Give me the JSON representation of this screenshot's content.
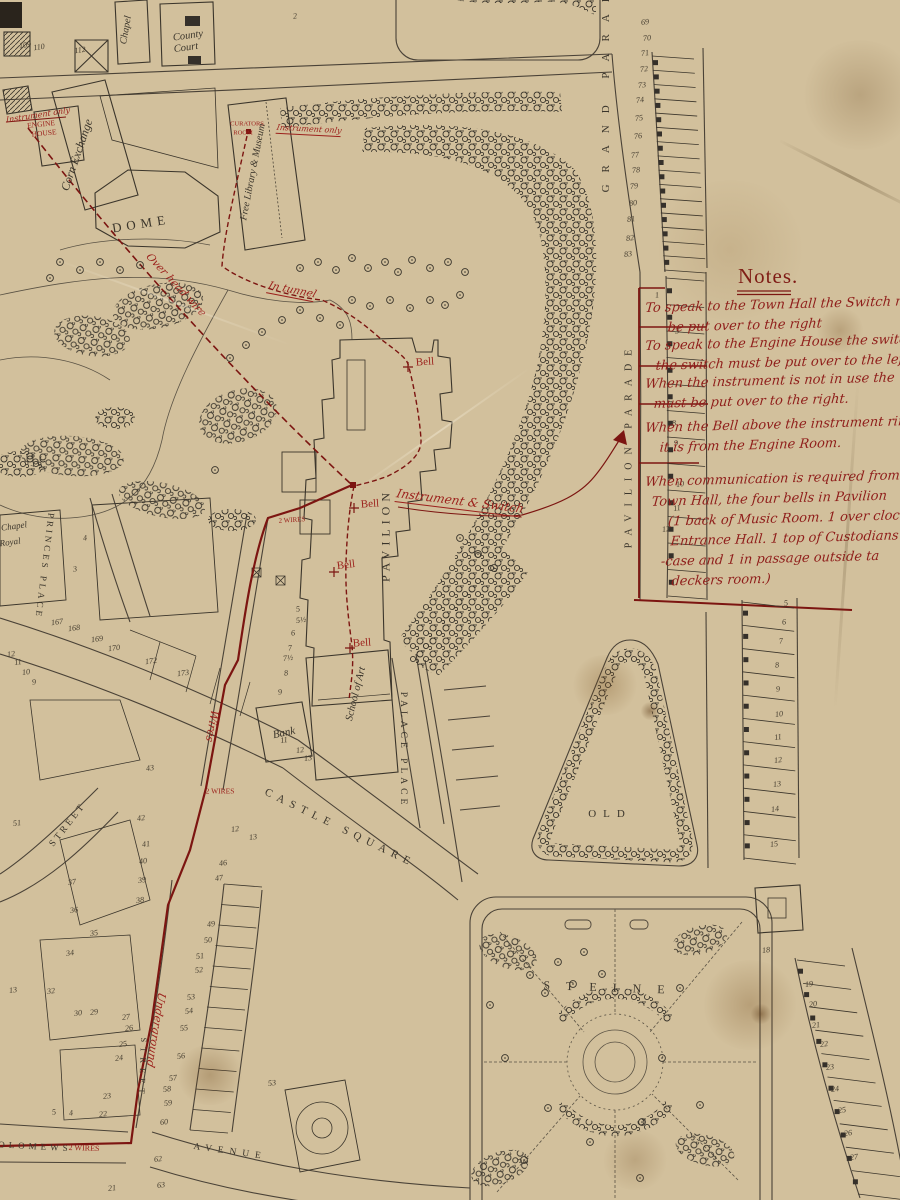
{
  "map_title_area": {
    "notes_title": "Notes."
  },
  "notes": {
    "title": "Notes.",
    "items": [
      {
        "lines": [
          {
            "t": "To speak to the Town Hall the Switch mu",
            "dx": 0
          },
          {
            "t": "be put over to the right",
            "dx": 24
          }
        ]
      },
      {
        "lines": [
          {
            "t": "To speak to the Engine House the switch",
            "dx": 0
          },
          {
            "t": "the switch must be put over to the left",
            "dx": 12
          }
        ]
      },
      {
        "lines": [
          {
            "t": "When the instrument is not in use the",
            "dx": 0
          },
          {
            "t": "must be put over to the right.",
            "dx": 10
          }
        ]
      },
      {
        "lines": [
          {
            "t": "When the Bell above the instrument ring",
            "dx": 0
          },
          {
            "t": "it is from the Engine Room.",
            "dx": 16
          }
        ]
      },
      {
        "lines": [
          {
            "t": "When communication is required from",
            "dx": 0
          },
          {
            "t": "Town Hall, the four bells in Pavilion",
            "dx": 8
          },
          {
            "t": "(1 back of Music Room. 1 over clock",
            "dx": 26
          },
          {
            "t": "Entrance Hall. 1 top of Custodians s",
            "dx": 30
          },
          {
            "t": "-case and 1 in passage outside ta",
            "dx": 22
          },
          {
            "t": "deckers room.)",
            "dx": 34
          }
        ]
      }
    ]
  },
  "labels": {
    "black": [
      {
        "t": "Chapel",
        "x": 126,
        "y": 30,
        "r": -80,
        "s": 10,
        "ls": 0,
        "k": "i"
      },
      {
        "t": "County",
        "x": 188,
        "y": 36,
        "r": -8,
        "s": 10.5,
        "ls": 0,
        "k": "i"
      },
      {
        "t": "Court",
        "x": 186,
        "y": 48,
        "r": -8,
        "s": 10.5,
        "ls": 0,
        "k": "i"
      },
      {
        "t": "Corn Exchange",
        "x": 77,
        "y": 155,
        "r": -71,
        "s": 12,
        "ls": 0,
        "k": "i"
      },
      {
        "t": "DOME",
        "x": 141,
        "y": 224,
        "r": -9,
        "s": 13,
        "ls": 5,
        "k": "cap"
      },
      {
        "t": "Free Library & Museum",
        "x": 253,
        "y": 172,
        "r": -79,
        "s": 10,
        "ls": 0,
        "k": "i"
      },
      {
        "t": "GRAND PARADE",
        "x": 606,
        "y": 78,
        "r": -90,
        "s": 11,
        "ls": 12,
        "k": "cap"
      },
      {
        "t": "PAVILION PARADE",
        "x": 629,
        "y": 445,
        "r": -90,
        "s": 10,
        "ls": 8,
        "k": "cap"
      },
      {
        "t": "PAVILION",
        "x": 386,
        "y": 535,
        "r": -90,
        "s": 12,
        "ls": 5,
        "k": "cap"
      },
      {
        "t": "School of Art",
        "x": 356,
        "y": 694,
        "r": -76,
        "s": 10.5,
        "ls": 0,
        "k": "i"
      },
      {
        "t": "Bank",
        "x": 284,
        "y": 733,
        "r": -12,
        "s": 11,
        "ls": 0,
        "k": "i"
      },
      {
        "t": "PALACE PLACE",
        "x": 403,
        "y": 750,
        "r": 90,
        "s": 9.5,
        "ls": 4,
        "k": "cap"
      },
      {
        "t": "CASTLE SQUARE",
        "x": 340,
        "y": 828,
        "r": 26,
        "s": 11,
        "ls": 6,
        "k": "cap"
      },
      {
        "t": "PRINCES PLACE",
        "x": 45,
        "y": 566,
        "r": 97,
        "s": 9,
        "ls": 3,
        "k": "cap"
      },
      {
        "t": "STREET",
        "x": 68,
        "y": 825,
        "r": -52,
        "s": 9.5,
        "ls": 3,
        "k": "cap"
      },
      {
        "t": "STREET",
        "x": 143,
        "y": 1068,
        "r": 92,
        "s": 8.5,
        "ls": 5,
        "k": "cap"
      },
      {
        "t": "OLD",
        "x": 610,
        "y": 814,
        "r": 0,
        "s": 11,
        "ls": 7,
        "k": "cap"
      },
      {
        "t": "STEINE",
        "x": 612,
        "y": 988,
        "r": 2,
        "s": 12,
        "ls": 16,
        "k": "cap"
      },
      {
        "t": "AVENUE",
        "x": 230,
        "y": 1152,
        "r": 8,
        "s": 9.5,
        "ls": 6,
        "k": "cap"
      },
      {
        "t": "BARTHOLOMEWS",
        "x": 10,
        "y": 1145,
        "r": 3,
        "s": 9,
        "ls": 4,
        "k": "cap"
      },
      {
        "t": "Chapel",
        "x": 14,
        "y": 526,
        "r": -8,
        "s": 9,
        "ls": 0,
        "k": "i"
      },
      {
        "t": "Royal",
        "x": 10,
        "y": 542,
        "r": -8,
        "s": 9,
        "ls": 0,
        "k": "i"
      }
    ],
    "red": [
      {
        "t": "Instrument only",
        "x": 38,
        "y": 115,
        "r": -9,
        "s": 8,
        "k": "sc"
      },
      {
        "t": "ENGINE",
        "x": 41,
        "y": 124,
        "r": -6,
        "s": 7.5,
        "k": "cap"
      },
      {
        "t": "HOUSE",
        "x": 44,
        "y": 133,
        "r": -6,
        "s": 7.5,
        "k": "cap"
      },
      {
        "t": "CURATORS",
        "x": 247,
        "y": 124,
        "r": 0,
        "s": 6.5,
        "k": "cap"
      },
      {
        "t": "ROOM",
        "x": 243,
        "y": 133,
        "r": 0,
        "s": 6.5,
        "k": "cap"
      },
      {
        "t": "Instrument only",
        "x": 309,
        "y": 130,
        "r": 3,
        "s": 8,
        "k": "sc",
        "u": 1
      },
      {
        "t": "Over head wire",
        "x": 176,
        "y": 285,
        "r": 47,
        "s": 10.5,
        "k": "sc"
      },
      {
        "t": "In tunnel",
        "x": 292,
        "y": 291,
        "r": 11,
        "s": 10.5,
        "k": "sc",
        "u": 1
      },
      {
        "t": "Bell",
        "x": 425,
        "y": 362,
        "r": -4,
        "s": 11,
        "k": "cap"
      },
      {
        "t": "Bell",
        "x": 370,
        "y": 504,
        "r": -4,
        "s": 11,
        "k": "cap"
      },
      {
        "t": "Bell",
        "x": 346,
        "y": 565,
        "r": -7,
        "s": 11,
        "k": "cap"
      },
      {
        "t": "Bell",
        "x": 362,
        "y": 643,
        "r": -4,
        "s": 11,
        "k": "cap"
      },
      {
        "t": "Instrument & Switch",
        "x": 460,
        "y": 502,
        "r": 7,
        "s": 12,
        "k": "sc",
        "u": 1
      },
      {
        "t": "2 WIRES",
        "x": 292,
        "y": 520,
        "r": -4,
        "s": 7,
        "k": "cap"
      },
      {
        "t": "2 WIRES",
        "x": 220,
        "y": 791,
        "r": 0,
        "s": 7.5,
        "k": "cap"
      },
      {
        "t": "2 WIRES",
        "x": 84,
        "y": 1148,
        "r": 2,
        "s": 8,
        "k": "cap"
      },
      {
        "t": "Wires",
        "x": 212,
        "y": 726,
        "r": 100,
        "s": 11,
        "k": "sc"
      },
      {
        "t": "Underground",
        "x": 156,
        "y": 1030,
        "r": 99,
        "s": 11,
        "k": "sc"
      }
    ]
  },
  "numbers": [
    {
      "n": "109",
      "x": 25,
      "y": 45
    },
    {
      "n": "110",
      "x": 39,
      "y": 47
    },
    {
      "n": "112",
      "x": 80,
      "y": 50
    },
    {
      "n": "69",
      "x": 645,
      "y": 22
    },
    {
      "n": "70",
      "x": 647,
      "y": 38
    },
    {
      "n": "71",
      "x": 645,
      "y": 53
    },
    {
      "n": "72",
      "x": 644,
      "y": 69
    },
    {
      "n": "73",
      "x": 642,
      "y": 85
    },
    {
      "n": "74",
      "x": 640,
      "y": 100
    },
    {
      "n": "75",
      "x": 639,
      "y": 118
    },
    {
      "n": "76",
      "x": 638,
      "y": 136
    },
    {
      "n": "77",
      "x": 635,
      "y": 155
    },
    {
      "n": "78",
      "x": 636,
      "y": 170
    },
    {
      "n": "79",
      "x": 634,
      "y": 186
    },
    {
      "n": "80",
      "x": 633,
      "y": 203
    },
    {
      "n": "81",
      "x": 631,
      "y": 219
    },
    {
      "n": "82",
      "x": 630,
      "y": 238
    },
    {
      "n": "83",
      "x": 628,
      "y": 254
    },
    {
      "n": "1",
      "x": 657,
      "y": 295
    },
    {
      "n": "3",
      "x": 677,
      "y": 331
    },
    {
      "n": "7",
      "x": 670,
      "y": 404
    },
    {
      "n": "8",
      "x": 674,
      "y": 423
    },
    {
      "n": "9",
      "x": 676,
      "y": 443
    },
    {
      "n": "10",
      "x": 680,
      "y": 484
    },
    {
      "n": "11",
      "x": 677,
      "y": 508
    },
    {
      "n": "12",
      "x": 666,
      "y": 529
    },
    {
      "n": "5",
      "x": 786,
      "y": 603
    },
    {
      "n": "6",
      "x": 784,
      "y": 622
    },
    {
      "n": "7",
      "x": 781,
      "y": 641
    },
    {
      "n": "8",
      "x": 777,
      "y": 665
    },
    {
      "n": "9",
      "x": 778,
      "y": 689
    },
    {
      "n": "10",
      "x": 779,
      "y": 714
    },
    {
      "n": "11",
      "x": 778,
      "y": 737
    },
    {
      "n": "12",
      "x": 778,
      "y": 760
    },
    {
      "n": "13",
      "x": 777,
      "y": 784
    },
    {
      "n": "14",
      "x": 775,
      "y": 809
    },
    {
      "n": "15",
      "x": 774,
      "y": 844
    },
    {
      "n": "18",
      "x": 766,
      "y": 950
    },
    {
      "n": "19",
      "x": 809,
      "y": 984
    },
    {
      "n": "20",
      "x": 813,
      "y": 1004
    },
    {
      "n": "21",
      "x": 816,
      "y": 1025
    },
    {
      "n": "22",
      "x": 824,
      "y": 1044
    },
    {
      "n": "23",
      "x": 830,
      "y": 1067
    },
    {
      "n": "24",
      "x": 835,
      "y": 1089
    },
    {
      "n": "25",
      "x": 842,
      "y": 1110
    },
    {
      "n": "26",
      "x": 848,
      "y": 1133
    },
    {
      "n": "27",
      "x": 854,
      "y": 1157
    },
    {
      "n": "4",
      "x": 85,
      "y": 538
    },
    {
      "n": "3",
      "x": 75,
      "y": 569
    },
    {
      "n": "167",
      "x": 57,
      "y": 622
    },
    {
      "n": "168",
      "x": 74,
      "y": 628
    },
    {
      "n": "169",
      "x": 97,
      "y": 639
    },
    {
      "n": "170",
      "x": 114,
      "y": 648
    },
    {
      "n": "172",
      "x": 151,
      "y": 661
    },
    {
      "n": "173",
      "x": 183,
      "y": 673
    },
    {
      "n": "12",
      "x": 11,
      "y": 654
    },
    {
      "n": "11",
      "x": 18,
      "y": 662
    },
    {
      "n": "10",
      "x": 26,
      "y": 672
    },
    {
      "n": "9",
      "x": 34,
      "y": 682
    },
    {
      "n": "5",
      "x": 298,
      "y": 609
    },
    {
      "n": "5½",
      "x": 301,
      "y": 620
    },
    {
      "n": "6",
      "x": 293,
      "y": 633
    },
    {
      "n": "7",
      "x": 290,
      "y": 648
    },
    {
      "n": "7½",
      "x": 288,
      "y": 658
    },
    {
      "n": "8",
      "x": 286,
      "y": 673
    },
    {
      "n": "9",
      "x": 280,
      "y": 692
    },
    {
      "n": "11",
      "x": 284,
      "y": 740
    },
    {
      "n": "12",
      "x": 300,
      "y": 750
    },
    {
      "n": "13",
      "x": 308,
      "y": 758
    },
    {
      "n": "51",
      "x": 17,
      "y": 823
    },
    {
      "n": "43",
      "x": 150,
      "y": 768
    },
    {
      "n": "42",
      "x": 141,
      "y": 818
    },
    {
      "n": "41",
      "x": 146,
      "y": 844
    },
    {
      "n": "40",
      "x": 143,
      "y": 861
    },
    {
      "n": "39",
      "x": 142,
      "y": 880
    },
    {
      "n": "38",
      "x": 140,
      "y": 900
    },
    {
      "n": "37",
      "x": 72,
      "y": 882
    },
    {
      "n": "36",
      "x": 74,
      "y": 910
    },
    {
      "n": "35",
      "x": 94,
      "y": 933
    },
    {
      "n": "34",
      "x": 70,
      "y": 953
    },
    {
      "n": "32",
      "x": 51,
      "y": 991
    },
    {
      "n": "13",
      "x": 13,
      "y": 990
    },
    {
      "n": "30",
      "x": 78,
      "y": 1013
    },
    {
      "n": "29",
      "x": 94,
      "y": 1012
    },
    {
      "n": "27",
      "x": 126,
      "y": 1017
    },
    {
      "n": "26",
      "x": 129,
      "y": 1028
    },
    {
      "n": "25",
      "x": 123,
      "y": 1044
    },
    {
      "n": "24",
      "x": 119,
      "y": 1058
    },
    {
      "n": "23",
      "x": 107,
      "y": 1096
    },
    {
      "n": "22",
      "x": 103,
      "y": 1114
    },
    {
      "n": "21",
      "x": 112,
      "y": 1188
    },
    {
      "n": "5",
      "x": 54,
      "y": 1112
    },
    {
      "n": "4",
      "x": 71,
      "y": 1113
    },
    {
      "n": "12",
      "x": 235,
      "y": 829
    },
    {
      "n": "13",
      "x": 253,
      "y": 837
    },
    {
      "n": "46",
      "x": 223,
      "y": 863
    },
    {
      "n": "47",
      "x": 219,
      "y": 878
    },
    {
      "n": "49",
      "x": 211,
      "y": 924
    },
    {
      "n": "50",
      "x": 208,
      "y": 940
    },
    {
      "n": "51",
      "x": 200,
      "y": 956
    },
    {
      "n": "52",
      "x": 199,
      "y": 970
    },
    {
      "n": "53",
      "x": 191,
      "y": 997
    },
    {
      "n": "54",
      "x": 189,
      "y": 1011
    },
    {
      "n": "55",
      "x": 184,
      "y": 1028
    },
    {
      "n": "56",
      "x": 181,
      "y": 1056
    },
    {
      "n": "57",
      "x": 173,
      "y": 1078
    },
    {
      "n": "58",
      "x": 167,
      "y": 1089
    },
    {
      "n": "59",
      "x": 168,
      "y": 1103
    },
    {
      "n": "60",
      "x": 164,
      "y": 1122
    },
    {
      "n": "62",
      "x": 158,
      "y": 1159
    },
    {
      "n": "63",
      "x": 161,
      "y": 1185
    },
    {
      "n": "53",
      "x": 272,
      "y": 1083
    },
    {
      "n": "2",
      "x": 295,
      "y": 16
    }
  ],
  "colors": {
    "paper": "#d2c09c",
    "black_ink": "#3b352b",
    "red_ink_line": "#7c1511",
    "red_ink_text": "#9c211c",
    "red_script": "#8f1d1a"
  }
}
